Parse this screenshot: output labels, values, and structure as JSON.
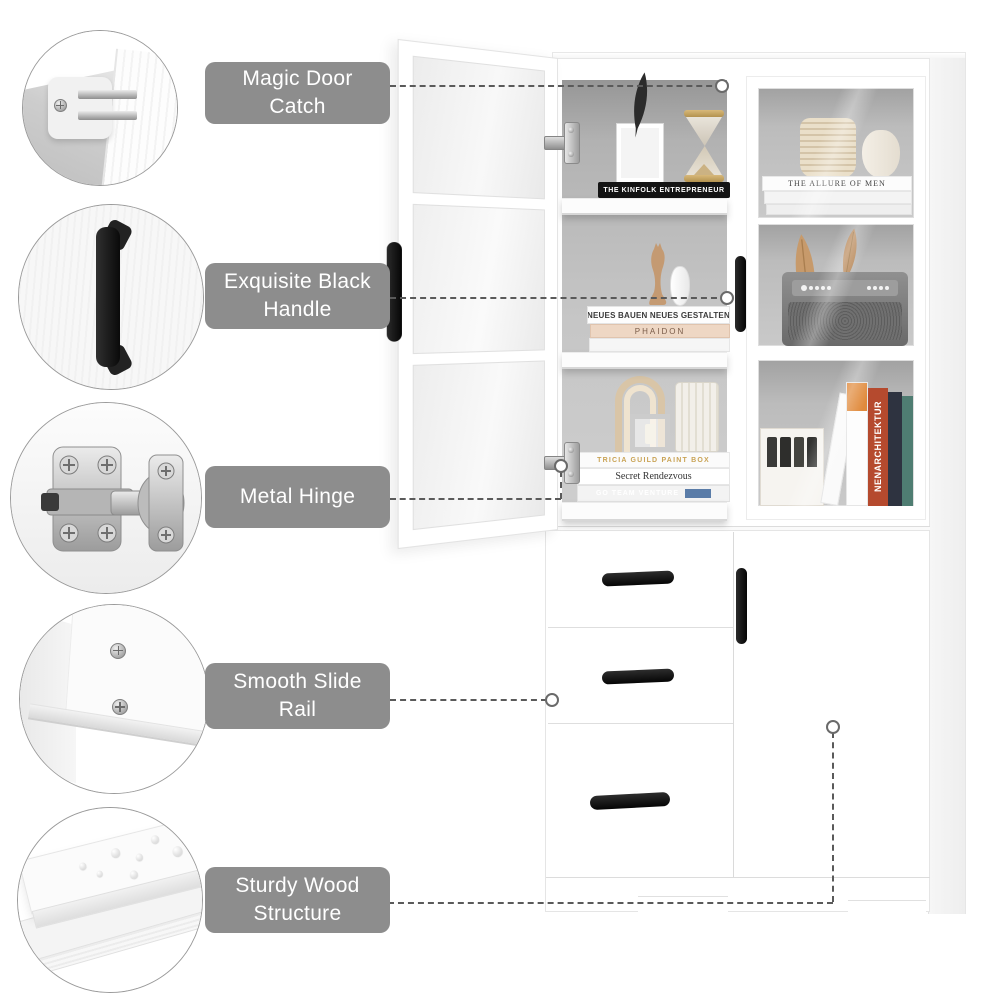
{
  "page": {
    "type": "product-feature-infographic",
    "background": "#ffffff"
  },
  "callouts": [
    {
      "label": "Magic Door Catch",
      "photo": "door-catch-photo"
    },
    {
      "label": "Exquisite Black Handle",
      "photo": "black-handle-photo"
    },
    {
      "label": "Metal Hinge",
      "photo": "metal-hinge-photo"
    },
    {
      "label": "Smooth Slide Rail",
      "photo": "slide-rail-photo"
    },
    {
      "label": "Sturdy Wood Structure",
      "photo": "wood-structure-photo"
    }
  ],
  "decor": {
    "books": {
      "kinfolk": "THE KINFOLK ENTREPRENEUR",
      "neues": "NEUES BAUEN NEUES GESTALTEN",
      "phaidon": "PHAIDON",
      "tricia": "TRICIA GUILD PAINT BOX",
      "secret": "Secret Rendezvous",
      "goteam": "GO TEAM VENTURE",
      "allure": "THE ALLURE OF MEN",
      "innen": "NENARCHITEKTUR"
    }
  },
  "colors": {
    "label_bg": "#8d8d8d",
    "label_text": "#ffffff",
    "connector": "#5a5a5a",
    "handle_black": "#141414",
    "interior_gray": "#b2b2b2",
    "hourglass_gold": "#b99a5e",
    "feather_tan": "#c79a6b",
    "phaidon_book": "#eed7c4",
    "orange_book_top": "#e08a3c",
    "red_spine": "#b54a2e",
    "navy_book": "#2e3340",
    "teal_book": "#4f7d72",
    "ribbed_vase": "#e3d4ba",
    "arch_decor": "#d9c5a7"
  }
}
